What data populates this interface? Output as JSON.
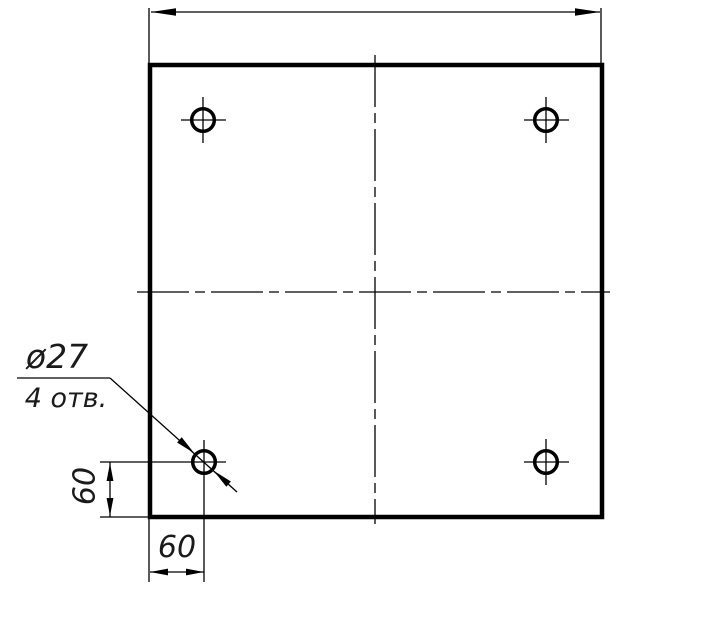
{
  "colors": {
    "background": "#ffffff",
    "line": "#000000",
    "text": "#1a1a1a"
  },
  "callout": {
    "diameter_label": "ø27",
    "count_label": "4 отв."
  },
  "dimensions": {
    "hole_offset_x": "60",
    "hole_offset_y": "60"
  }
}
